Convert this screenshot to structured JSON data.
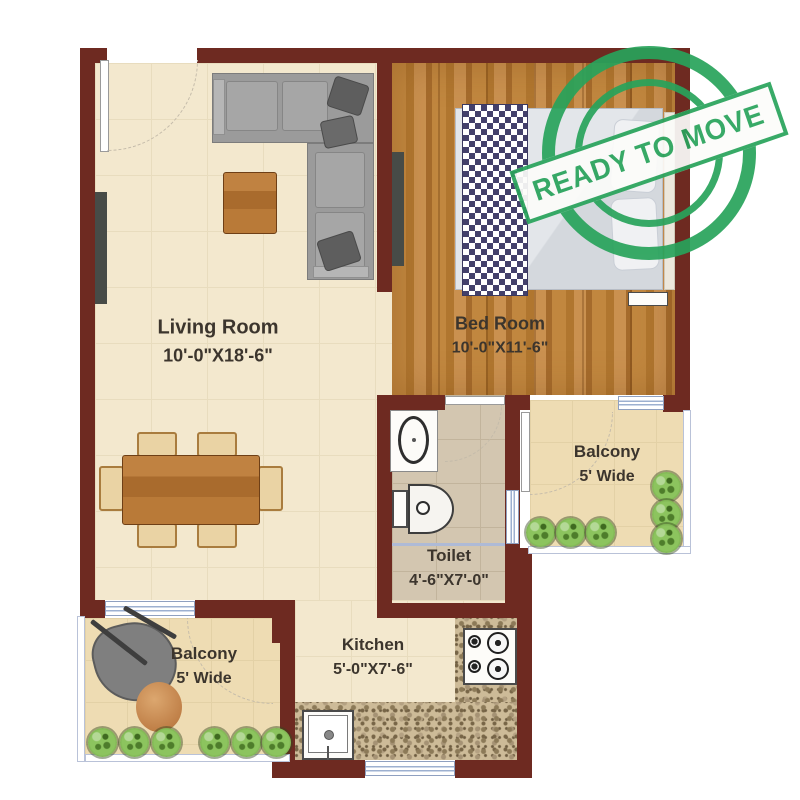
{
  "plan": {
    "rooms": {
      "living_room": {
        "name": "Living Room",
        "dims": "10'-0\"X18'-6\""
      },
      "bed_room": {
        "name": "Bed Room",
        "dims": "10'-0\"X11'-6\""
      },
      "toilet": {
        "name": "Toilet",
        "dims": "4'-6\"X7'-0\""
      },
      "kitchen": {
        "name": "Kitchen",
        "dims": "5'-0\"X7'-6\""
      },
      "balcony_right": {
        "name": "Balcony",
        "dims": "5' Wide"
      },
      "balcony_left": {
        "name": "Balcony",
        "dims": "5' Wide"
      }
    },
    "stamp": {
      "text": "READY TO MOVE"
    },
    "colors": {
      "wall": "#6e2a21",
      "stamp_green": "#28a35b",
      "wood_floor": "#c1873f",
      "tile_floor": "#f3e8ce",
      "toilet_floor": "#d3c6b0",
      "balcony_floor": "#eedcb3"
    }
  }
}
